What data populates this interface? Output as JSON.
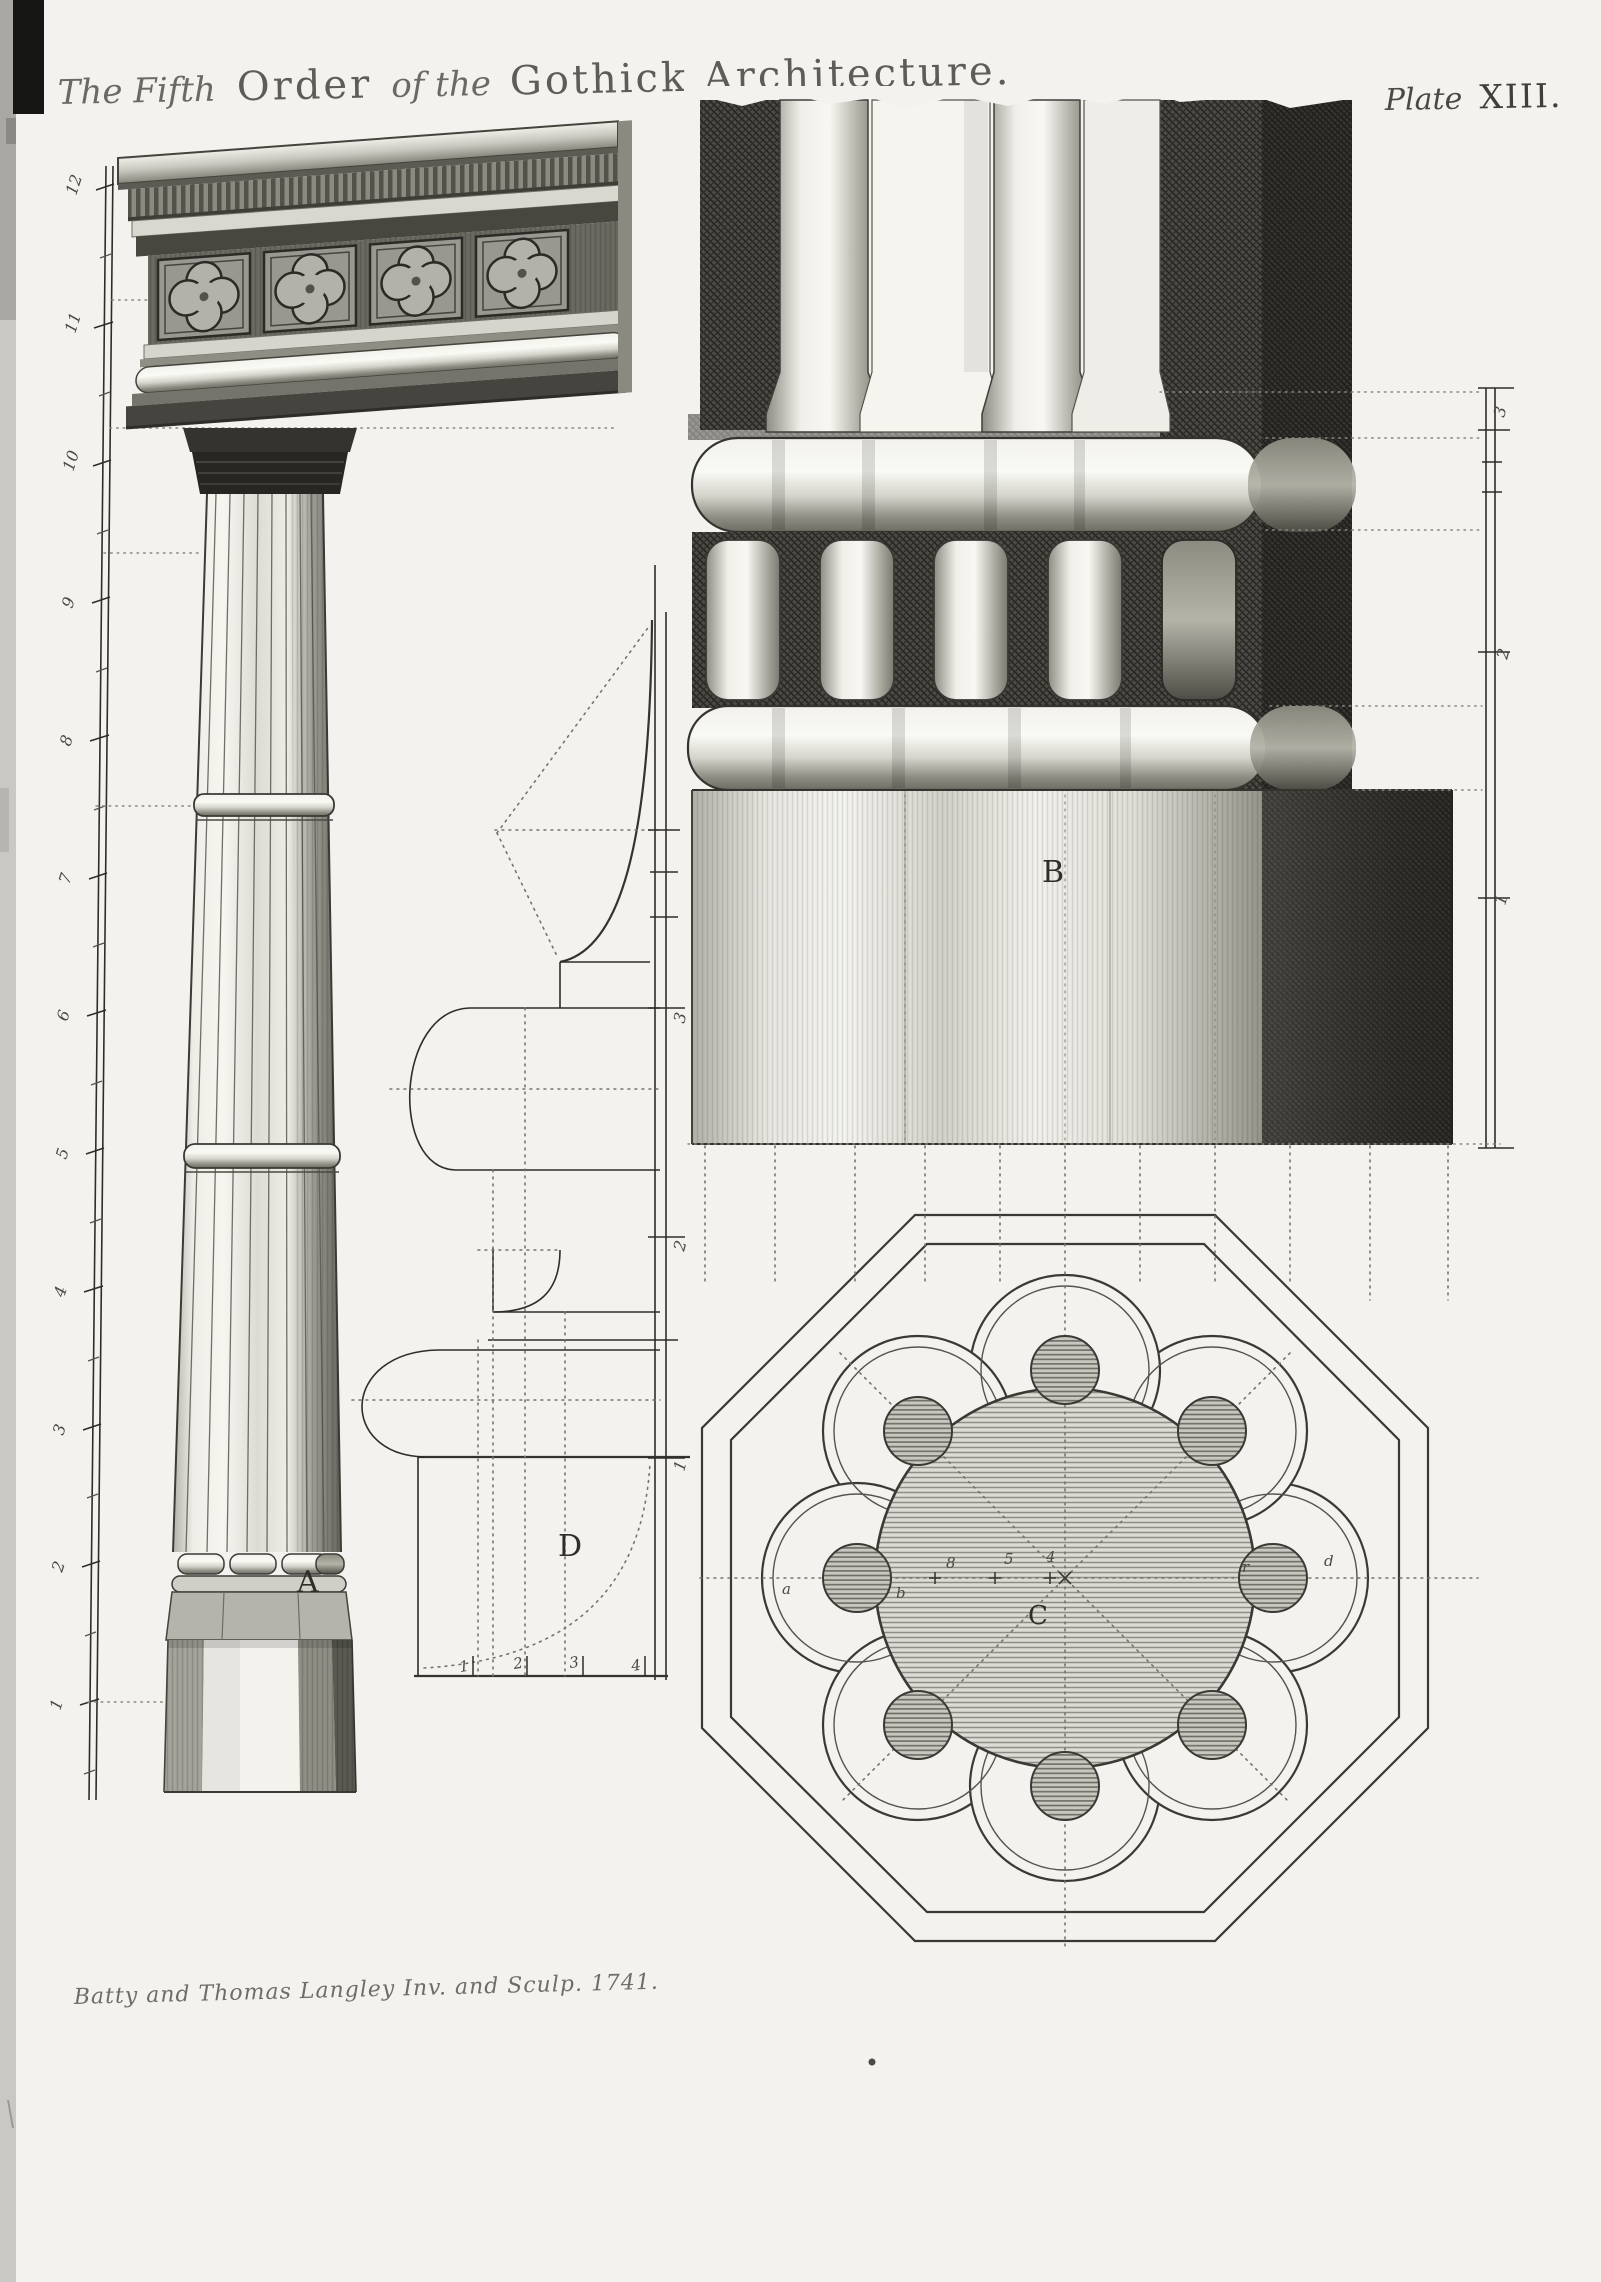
{
  "page": {
    "title": {
      "script_1": "The Fifth",
      "roman_1": "Order",
      "script_2": "of the",
      "roman_2": "Gothick Architecture."
    },
    "plate_label": {
      "script": "Plate",
      "roman": "XIII."
    },
    "signature": "Batty and Thomas Langley Inv. and Sculp. 1741."
  },
  "figures": {
    "column_elevation": {
      "label": "A",
      "ruler_labels": [
        "12",
        "11",
        "10",
        "9",
        "8",
        "7",
        "6",
        "5",
        "4",
        "3",
        "2",
        "1"
      ]
    },
    "base_detail": {
      "label": "B",
      "scale_labels": [
        "3",
        "2",
        "1"
      ]
    },
    "base_plan": {
      "label": "C",
      "centerline_labels": [
        "a",
        "b",
        "8",
        "5",
        "4",
        "r",
        "d"
      ]
    },
    "moulding_profile": {
      "label": "D",
      "right_scale_labels": [
        "3",
        "2",
        "1"
      ],
      "bottom_scale_labels": [
        "1",
        "2",
        "3",
        "4"
      ]
    }
  },
  "colors": {
    "paper": "#f3f2ee",
    "ink": "#2e2d29",
    "faded-ink": "#63625c",
    "hatch-mid": "#6b6a62",
    "hatch-dark": "#3a3934"
  }
}
